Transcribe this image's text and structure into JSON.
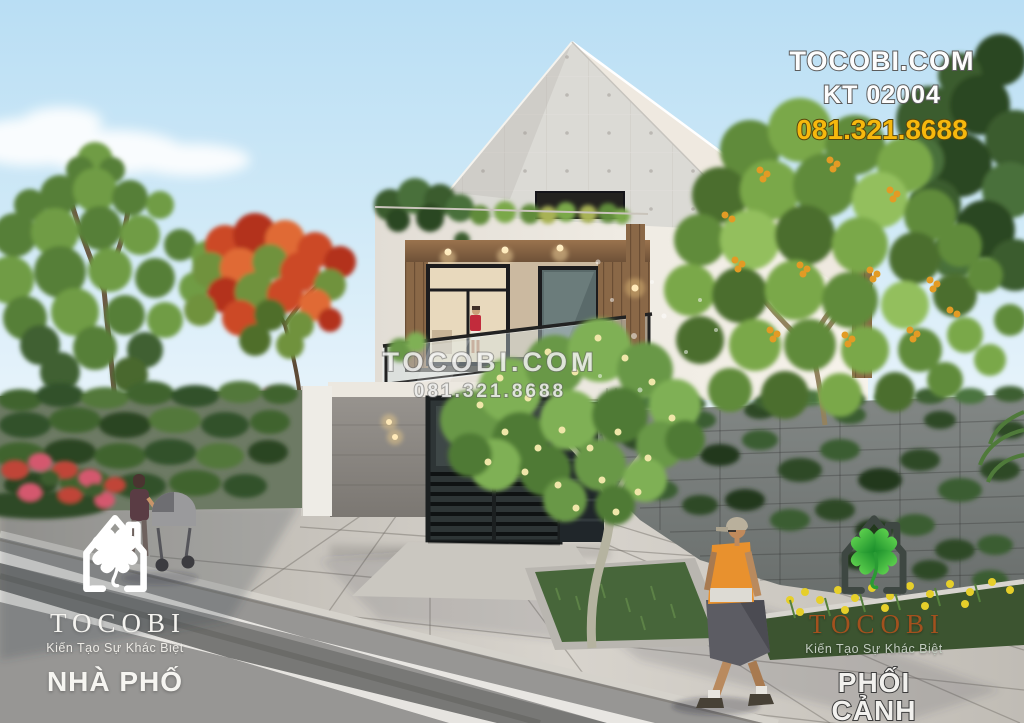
{
  "watermarks": {
    "top_right": {
      "site": "TOCOBI.COM",
      "code": "KT 02004",
      "phone": "081.321.8688"
    },
    "center": {
      "site": "TOCOBI.COM",
      "phone": "081.321.8688"
    }
  },
  "logos": {
    "left": {
      "brand": "TOCOBI",
      "tagline": "Kiến Tạo Sự Khác Biệt",
      "label": "NHÀ PHỐ"
    },
    "right": {
      "brand": "TOCOBI",
      "tagline": "Kiến Tạo Sự Khác Biệt",
      "label": "PHỐI CẢNH"
    }
  },
  "icons": {
    "logo_icon": "house-with-four-leaf-clover"
  },
  "colors": {
    "sky-top": "#b9def4",
    "sky-horizon": "#edf6fb",
    "phone-yellow": "#f6b80d",
    "outline-gray": "#5c5c5c",
    "watermark-white": "rgba(248,248,246,0.82)",
    "logo-white": "#f4f3ef",
    "logo-brown": "#a3511e",
    "clover-green": "#2fa136",
    "house-outline-dark": "#3e4742"
  }
}
